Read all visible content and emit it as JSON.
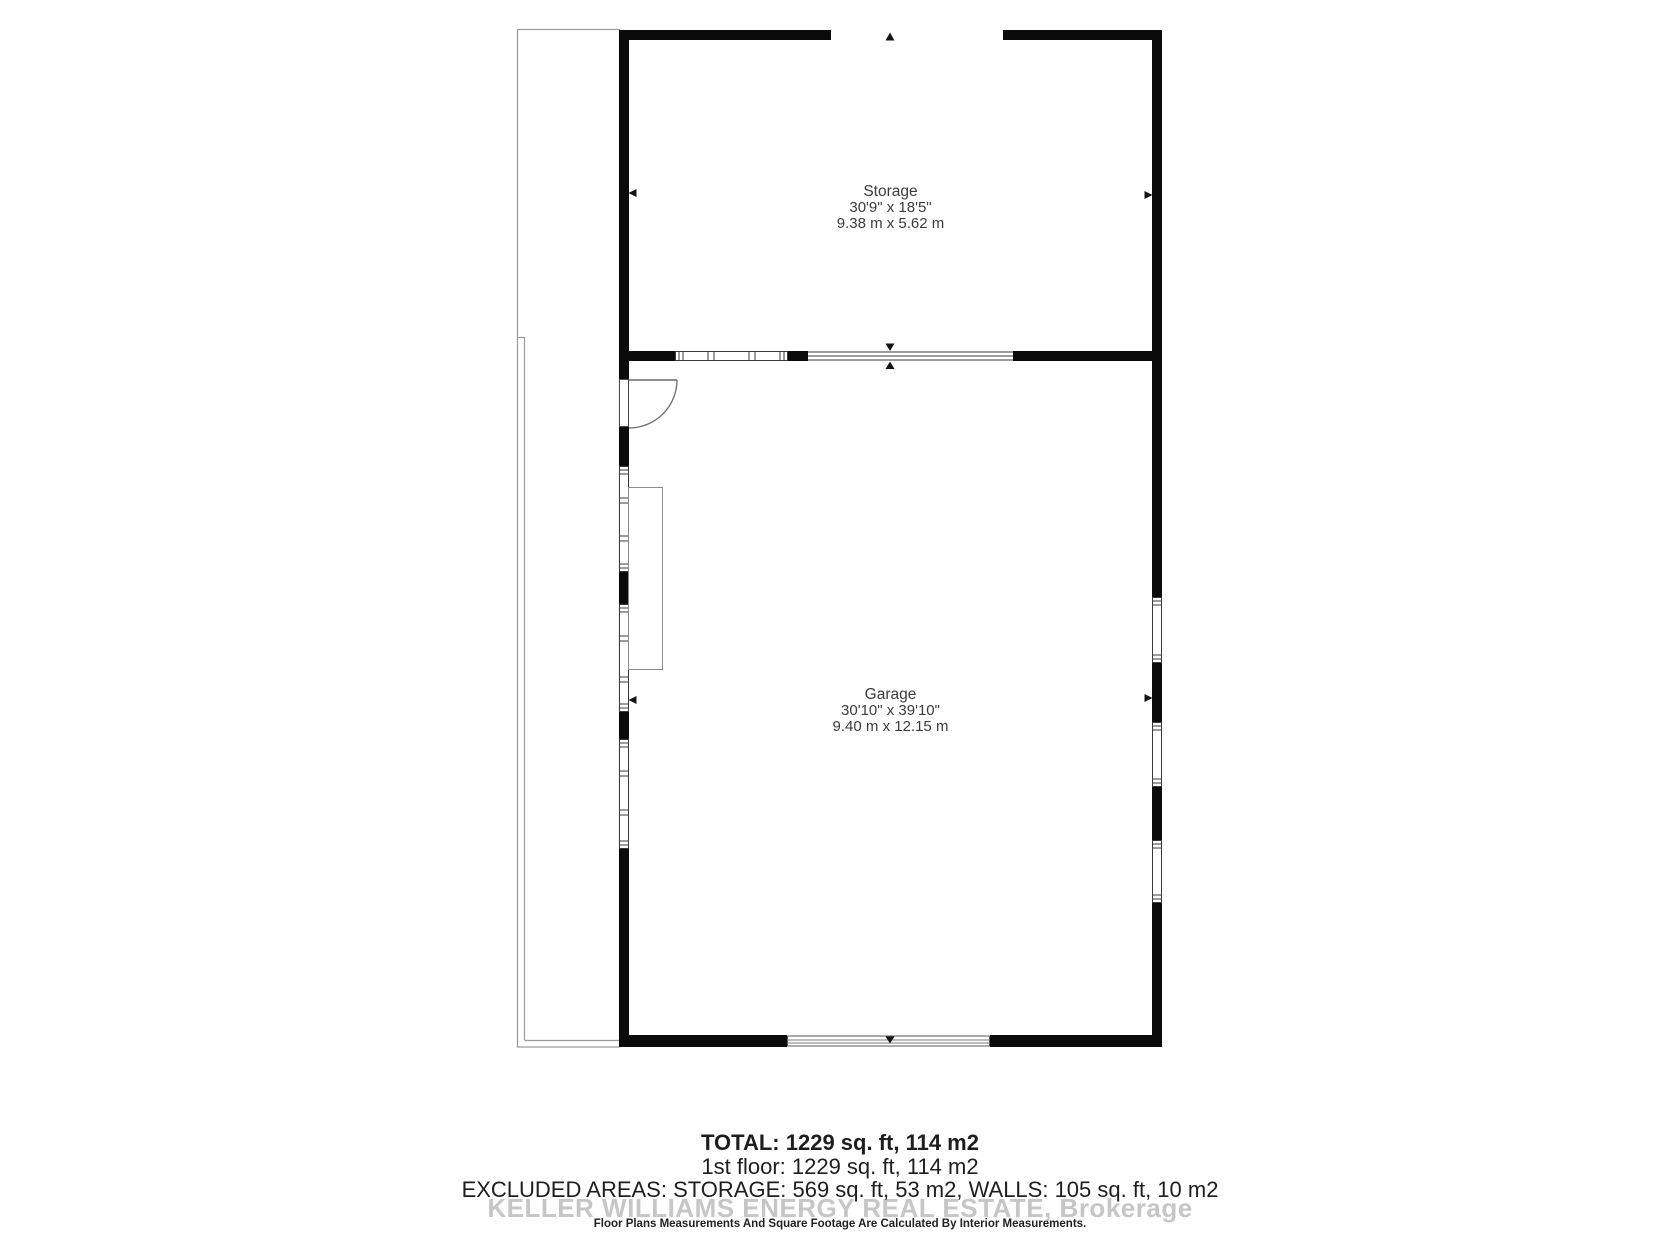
{
  "plan": {
    "rooms": [
      {
        "name": "Storage",
        "dims_imperial": "30'9\" x 18'5\"",
        "dims_metric": "9.38 m x 5.62 m"
      },
      {
        "name": "Garage",
        "dims_imperial": "30'10\" x 39'10\"",
        "dims_metric": "9.40 m x 12.15 m"
      }
    ],
    "markers": [
      "up-arrow-icon",
      "down-arrow-icon",
      "left-arrow-icon",
      "right-arrow-icon"
    ],
    "colors": {
      "wall": "#0b0b0b",
      "thin_outline": "#9a9a9a",
      "label_text": "#3b3b3b",
      "watermark": "#c6c6c6"
    }
  },
  "summary": {
    "total": "TOTAL: 1229 sq. ft, 114 m2",
    "first_floor": "1st floor: 1229 sq. ft, 114 m2",
    "excluded": "EXCLUDED AREAS: STORAGE: 569 sq. ft, 53 m2, WALLS: 105 sq. ft, 10 m2",
    "watermark": "KELLER WILLIAMS ENERGY REAL ESTATE, Brokerage",
    "disclaimer": "Floor Plans Measurements And Square Footage Are Calculated By Interior Measurements."
  }
}
